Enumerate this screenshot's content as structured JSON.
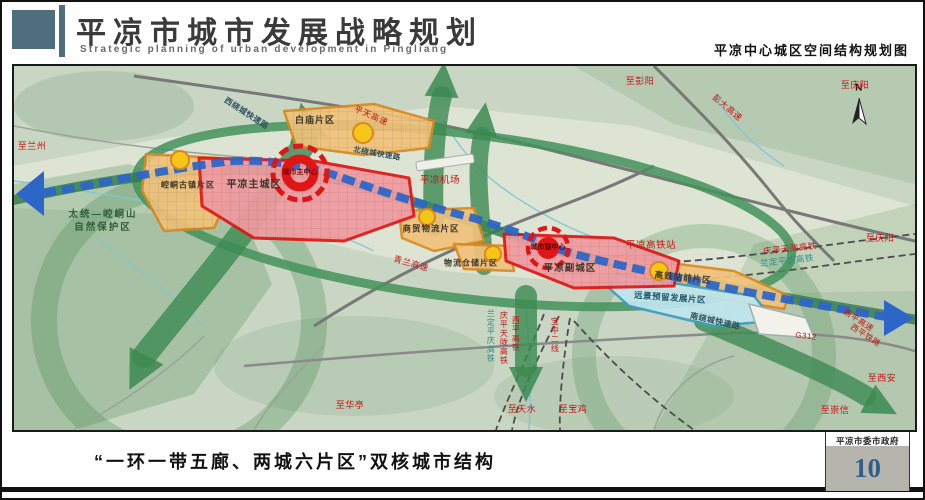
{
  "header": {
    "title_cn": "平凉市城市发展战略规划",
    "title_en": "Strategic planning of urban development in Pingliang",
    "map_title": "平凉中心城区空间结构规划图"
  },
  "footer": {
    "caption": "“一环一带五廊、两城六片区”双核城市结构",
    "agency": "平凉市委市政府",
    "page_number": "10"
  },
  "map": {
    "compass": "N",
    "districts": {
      "baimiao": "白庙片区",
      "kongtong_town": "崆峒古镇片区",
      "main_city": "平凉主城区",
      "main_core": "城市主中心",
      "trade_logistics": "商贸物流片区",
      "warehouse": "物流仓储片区",
      "sub_city": "平凉副城区",
      "sub_core": "城市副中心",
      "hsr_front": "高铁站前片区",
      "reserved": "远景预留发展片区"
    },
    "places": {
      "airport": "平凉机场",
      "hsr_station": "平凉高铁站",
      "nature_reserve_1": "太统—崆峒山",
      "nature_reserve_2": "自然保护区"
    },
    "roads": {
      "west_ring": "西绕城快速路",
      "north_ring": "北绕城快速路",
      "south_ring": "南绕城快速路",
      "pingtian_expwy": "平天高速",
      "pengda_expwy": "彭大高速",
      "qinglan_expwy": "青兰高速",
      "g312": "G312",
      "xiping_expwy": "西平高速",
      "xiping_railway": "西平铁路"
    },
    "railways": {
      "qingping_hsr_h": "庆平天陇高铁",
      "landing_hsr_h": "兰定平庆高铁",
      "landing_hsr_v": "兰定平庆高铁",
      "qingping_hsr_v": "庆平天陇高铁",
      "xiping_hsr_v": "西平高铁",
      "baozhong_line_v": "宝中二线"
    },
    "directions": {
      "to_lanzhou": "至兰州",
      "to_pengyang": "至彭阳",
      "to_qingyang_top": "至庆阳",
      "to_qingyang_right": "至庆阳",
      "to_xian": "至西安",
      "to_chongxin": "至崇信",
      "to_huating": "至华亭",
      "to_tianshui": "至天水",
      "to_baoji": "至宝鸡"
    }
  },
  "colors": {
    "brand_slate": "#4e6e7e",
    "core_red": "#e01616",
    "belt_blue": "#2d66c8",
    "corridor_green": "#3c8a52",
    "district_orange": "#e8941f",
    "district_cyan": "#3aa0c0",
    "page_number_blue": "#2e5f8a",
    "terrain_green": "#c9d6c4"
  }
}
